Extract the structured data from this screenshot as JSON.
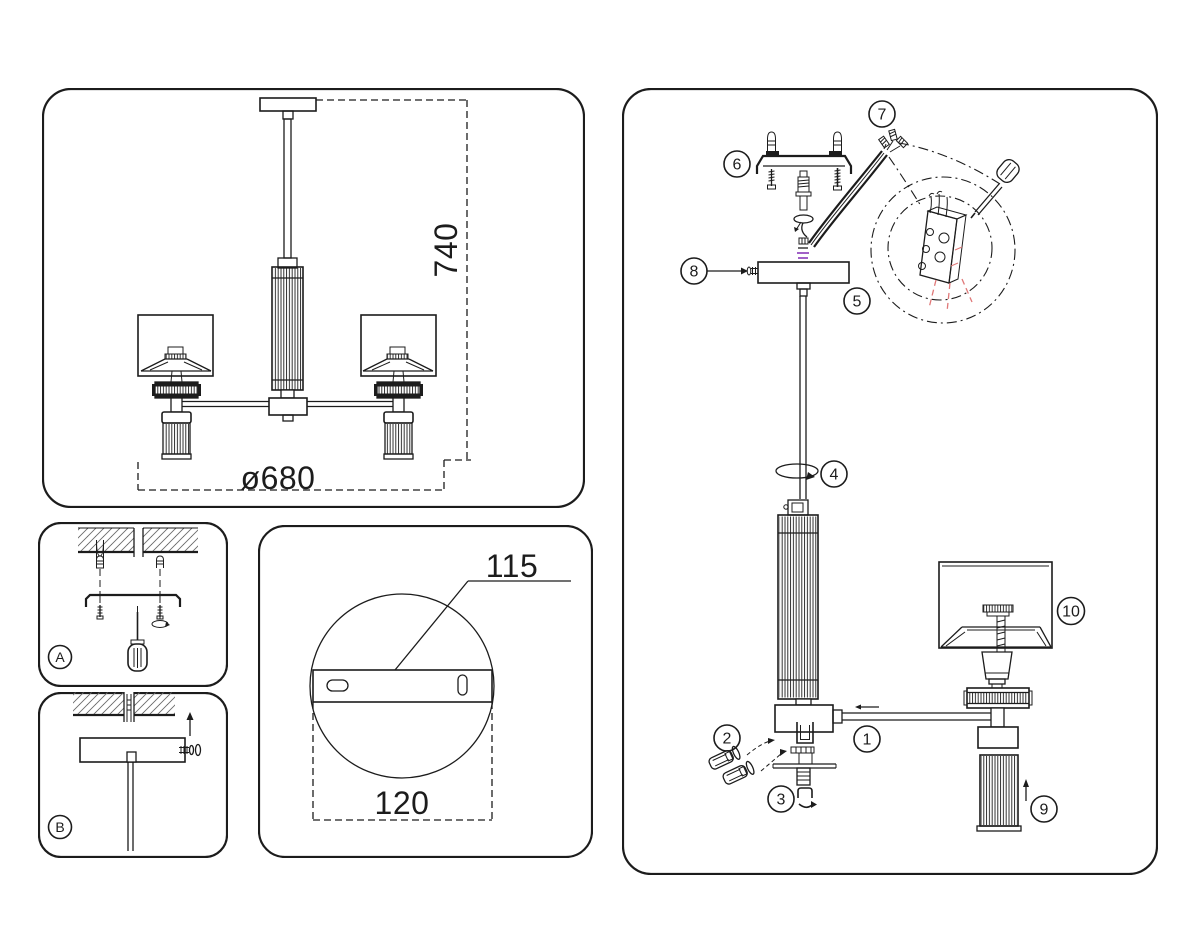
{
  "sheet": {
    "colors": {
      "line": "#1c1c1c",
      "accent_red": "#e07878",
      "accent_purple": "#9c59c4",
      "background": "#ffffff",
      "hatch": "#6a6a6a"
    }
  },
  "overview_panel": {
    "height_dim": "740",
    "diameter_dim": "ø680"
  },
  "step_panels": {
    "a_label": "A",
    "b_label": "B"
  },
  "plate_detail_panel": {
    "hole_spacing_dim": "115",
    "plate_width_dim": "120"
  },
  "assembly_panel": {
    "callouts": {
      "n1": "1",
      "n2": "2",
      "n3": "3",
      "n4": "4",
      "n5": "5",
      "n6": "6",
      "n7": "7",
      "n8": "8",
      "n9": "9",
      "n10": "10"
    }
  }
}
